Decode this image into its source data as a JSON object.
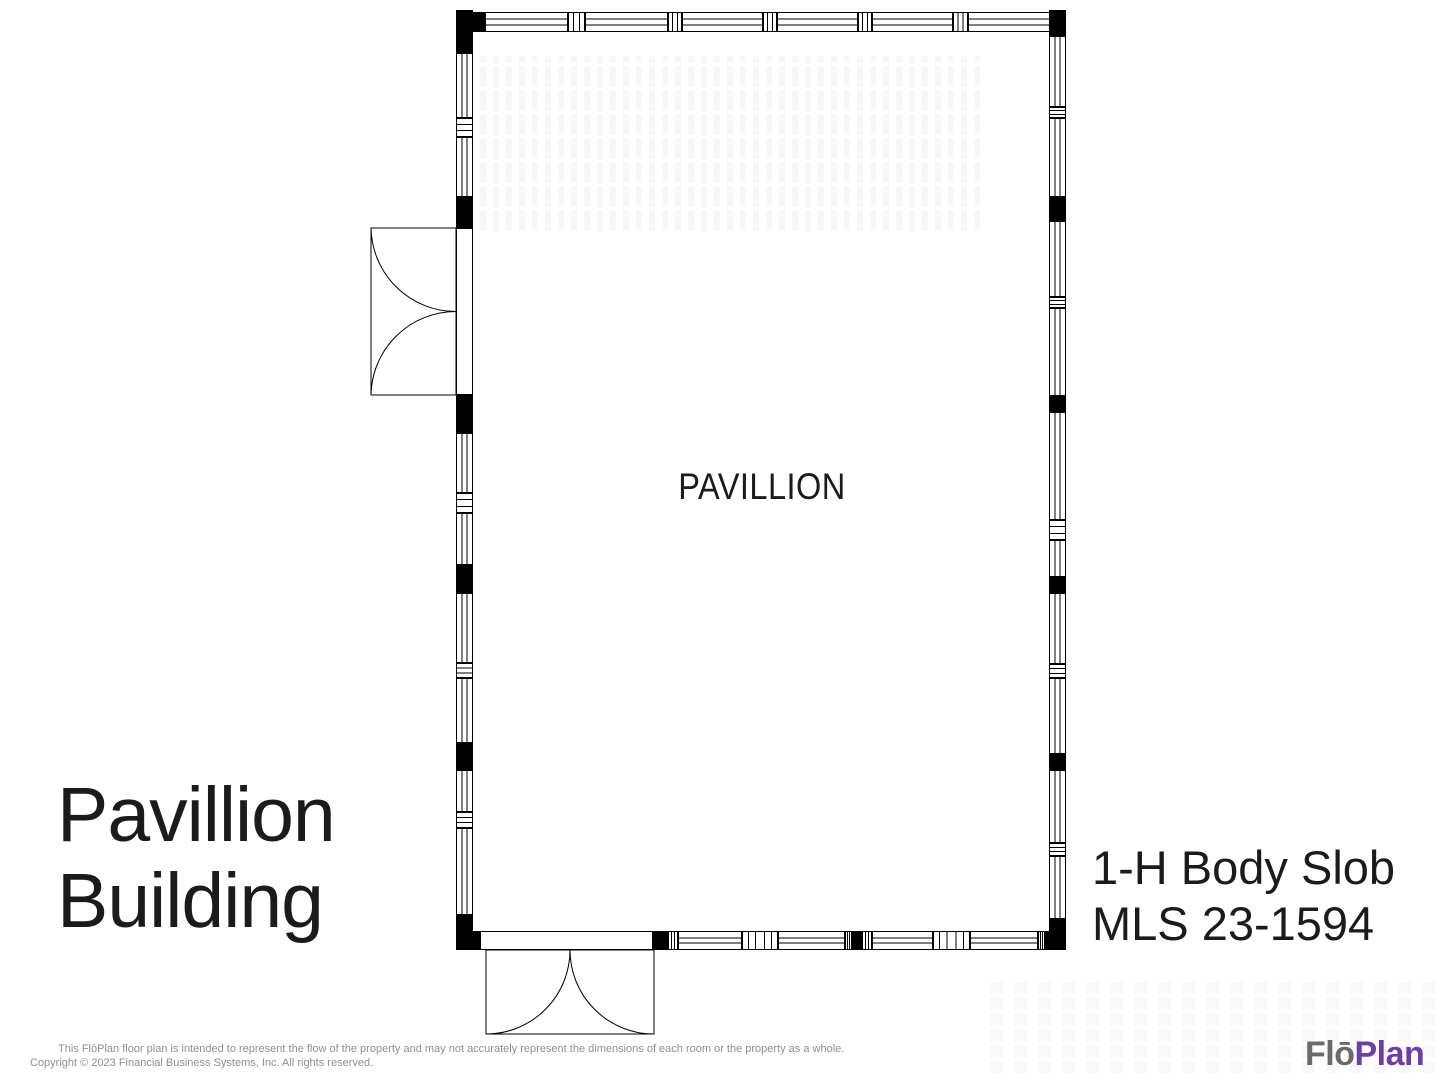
{
  "page": {
    "background": "#ffffff"
  },
  "floor_plan": {
    "room_label": "PAVILLION",
    "line_color": "#000000",
    "walls": [
      {
        "name": "top",
        "orient": "h",
        "x": 456,
        "y": 12,
        "len": 610,
        "thick": 20,
        "segments": [
          [
            "corner",
            29
          ],
          [
            "win",
            83
          ],
          [
            "mull",
            17
          ],
          [
            "win",
            83
          ],
          [
            "mull",
            14
          ],
          [
            "win",
            81
          ],
          [
            "mull",
            14
          ],
          [
            "win",
            81
          ],
          [
            "mull",
            14
          ],
          [
            "win",
            81
          ],
          [
            "mull",
            15
          ],
          [
            "win",
            84
          ],
          [
            "corner",
            14
          ]
        ]
      },
      {
        "name": "bottom",
        "orient": "h",
        "x": 456,
        "y": 931,
        "len": 610,
        "thick": 19,
        "segments": [
          [
            "corner",
            24
          ],
          [
            "door",
            173
          ],
          [
            "post",
            15
          ],
          [
            "mull",
            10
          ],
          [
            "win",
            64
          ],
          [
            "mull3",
            36
          ],
          [
            "win",
            67
          ],
          [
            "mull",
            7
          ],
          [
            "post",
            10
          ],
          [
            "mull",
            10
          ],
          [
            "win",
            61
          ],
          [
            "mull3",
            37
          ],
          [
            "win",
            68
          ],
          [
            "mull",
            7
          ],
          [
            "corner",
            21
          ]
        ]
      },
      {
        "name": "left",
        "orient": "v",
        "x": 456,
        "y": 10,
        "len": 940,
        "thick": 17,
        "segments": [
          [
            "corner",
            43
          ],
          [
            "win",
            65
          ],
          [
            "mull",
            19
          ],
          [
            "win",
            60
          ],
          [
            "post",
            31
          ],
          [
            "door",
            167
          ],
          [
            "post",
            38
          ],
          [
            "win",
            60
          ],
          [
            "mull",
            20
          ],
          [
            "win",
            52
          ],
          [
            "post",
            28
          ],
          [
            "win",
            70
          ],
          [
            "mull",
            15
          ],
          [
            "win",
            65
          ],
          [
            "post",
            27
          ],
          [
            "win",
            42
          ],
          [
            "mull",
            16
          ],
          [
            "win",
            87
          ],
          [
            "corner",
            35
          ]
        ]
      },
      {
        "name": "right",
        "orient": "v",
        "x": 1049,
        "y": 10,
        "len": 940,
        "thick": 17,
        "segments": [
          [
            "corner",
            26
          ],
          [
            "win",
            71
          ],
          [
            "mull",
            11
          ],
          [
            "win",
            79
          ],
          [
            "post",
            24
          ],
          [
            "win",
            76
          ],
          [
            "mull",
            11
          ],
          [
            "win",
            88
          ],
          [
            "post",
            16
          ],
          [
            "win",
            108
          ],
          [
            "mull",
            20
          ],
          [
            "win",
            37
          ],
          [
            "post",
            16
          ],
          [
            "win",
            71
          ],
          [
            "mull",
            14
          ],
          [
            "win",
            76
          ],
          [
            "post",
            16
          ],
          [
            "win",
            73
          ],
          [
            "mull",
            13
          ],
          [
            "win",
            63
          ],
          [
            "corner",
            31
          ]
        ]
      }
    ],
    "doors": [
      {
        "name": "side-double-door",
        "wall": "left",
        "axis_x": 456,
        "y1": 228,
        "y2": 395,
        "depth": 85
      },
      {
        "name": "entry-double-door",
        "wall": "bottom",
        "axis_y": 950,
        "x1": 486,
        "x2": 654,
        "depth": 84
      }
    ]
  },
  "labels": {
    "title_line1": "Pavillion",
    "title_line2": "Building",
    "listing_line1": "1-H Body Slob",
    "listing_line2": "MLS 23-1594"
  },
  "footer": {
    "line1": "This FlōPlan floor plan is intended to represent the flow of the property and may not accurately represent the dimensions of each room or the property as a whole.",
    "line2": "Copyright © 2023 Financial Business Systems, Inc. All rights reserved.",
    "text_color": "#8f8f8f"
  },
  "logo": {
    "part1": "Flō",
    "part2": "Plan",
    "part1_color": "#6b6b6e",
    "part2_color": "#6e3fa3"
  }
}
